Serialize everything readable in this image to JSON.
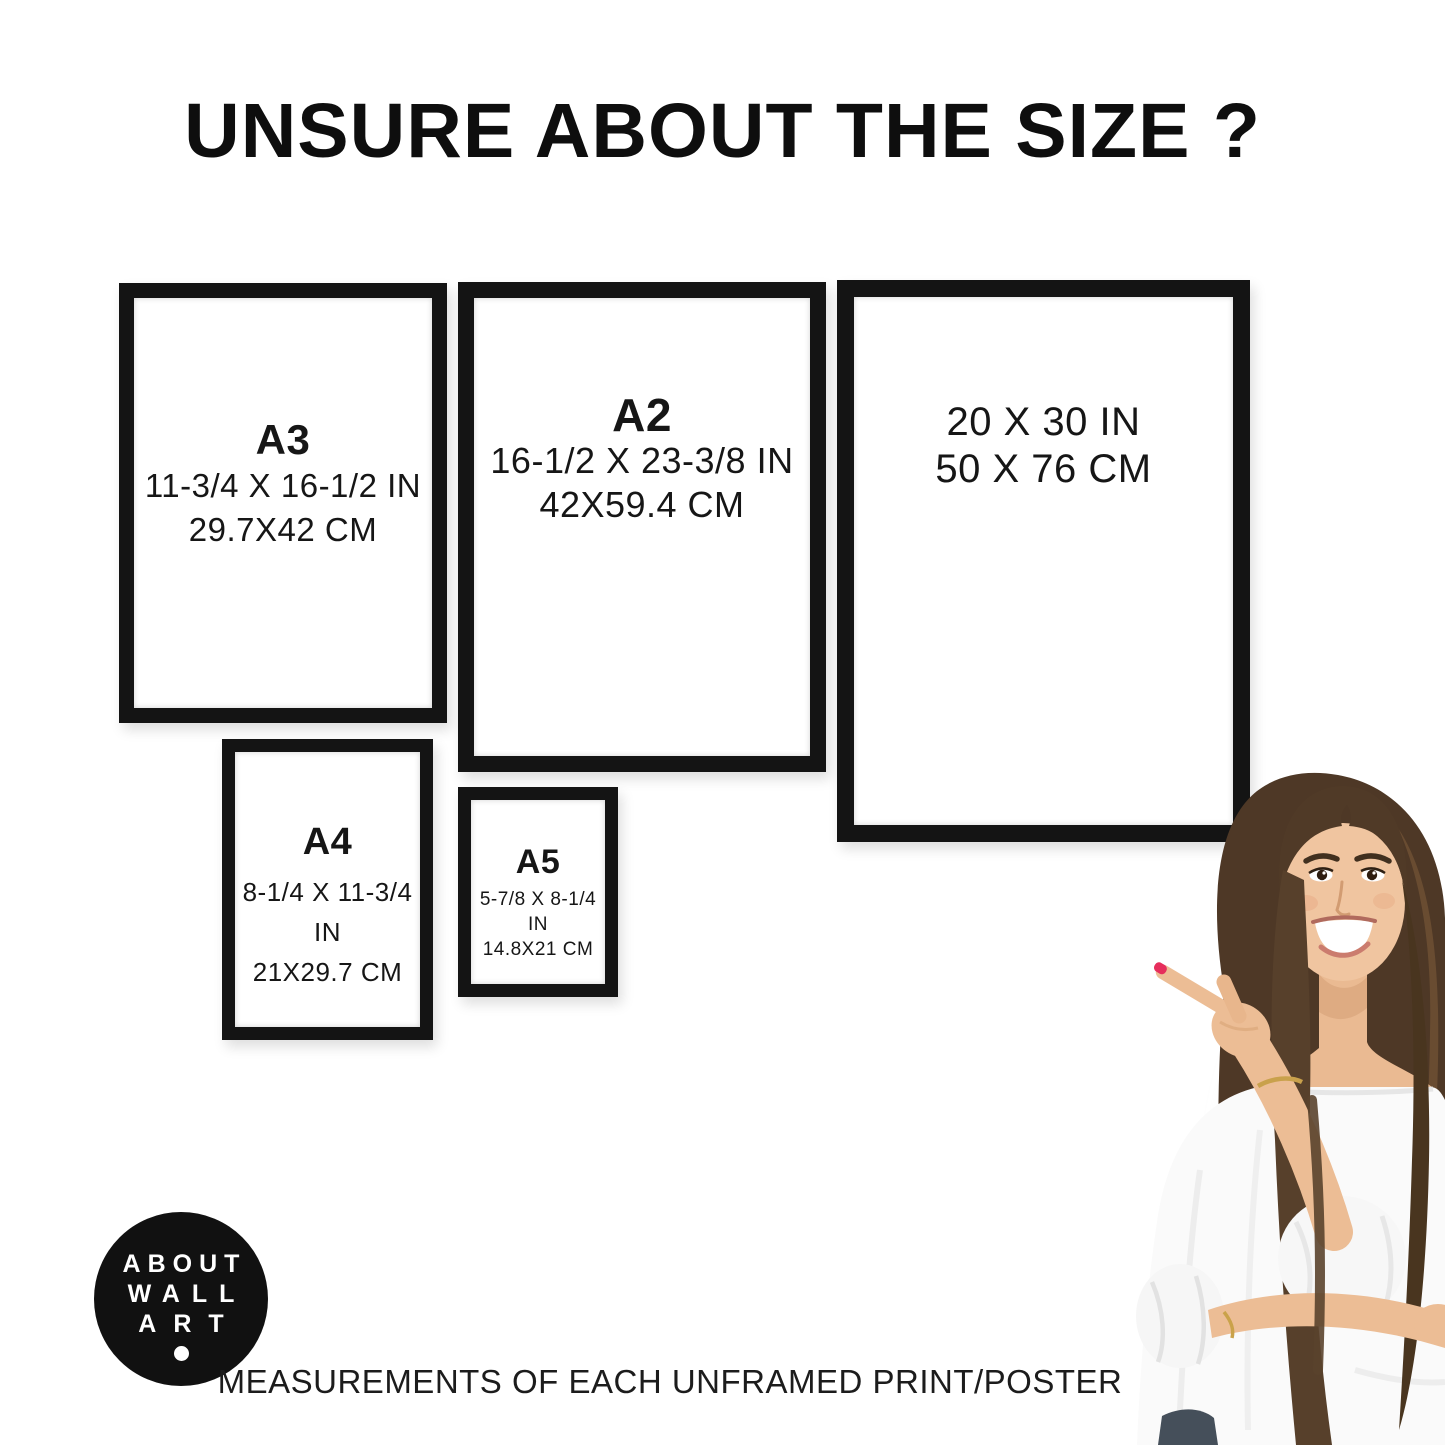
{
  "title": "UNSURE ABOUT THE SIZE ?",
  "frames": [
    {
      "id": "A3",
      "label": "A3",
      "inches": "11-3/4 X 16-1/2 IN",
      "cm": "29.7X42 CM"
    },
    {
      "id": "A2",
      "label": "A2",
      "inches": "16-1/2 X 23-3/8 IN",
      "cm": "42X59.4 CM"
    },
    {
      "id": "20x30",
      "label": "",
      "inches": "20 X 30 IN",
      "cm": "50 X 76 CM"
    },
    {
      "id": "A4",
      "label": "A4",
      "inches": "8-1/4 X 11-3/4 IN",
      "cm": "21X29.7 CM"
    },
    {
      "id": "A5",
      "label": "A5",
      "inches": "5-7/8 X 8-1/4 IN",
      "cm": "14.8X21 CM"
    }
  ],
  "logo": {
    "line1": "ABOUT",
    "line2": "WALL",
    "line3": "ART"
  },
  "caption": "MEASUREMENTS OF EACH UNFRAMED PRINT/POSTER",
  "colors": {
    "text": "#111111",
    "frame_border": "#141414",
    "background": "#ffffff",
    "logo_background": "#111111",
    "logo_text": "#ffffff",
    "nail_polish": "#e62e5c"
  }
}
